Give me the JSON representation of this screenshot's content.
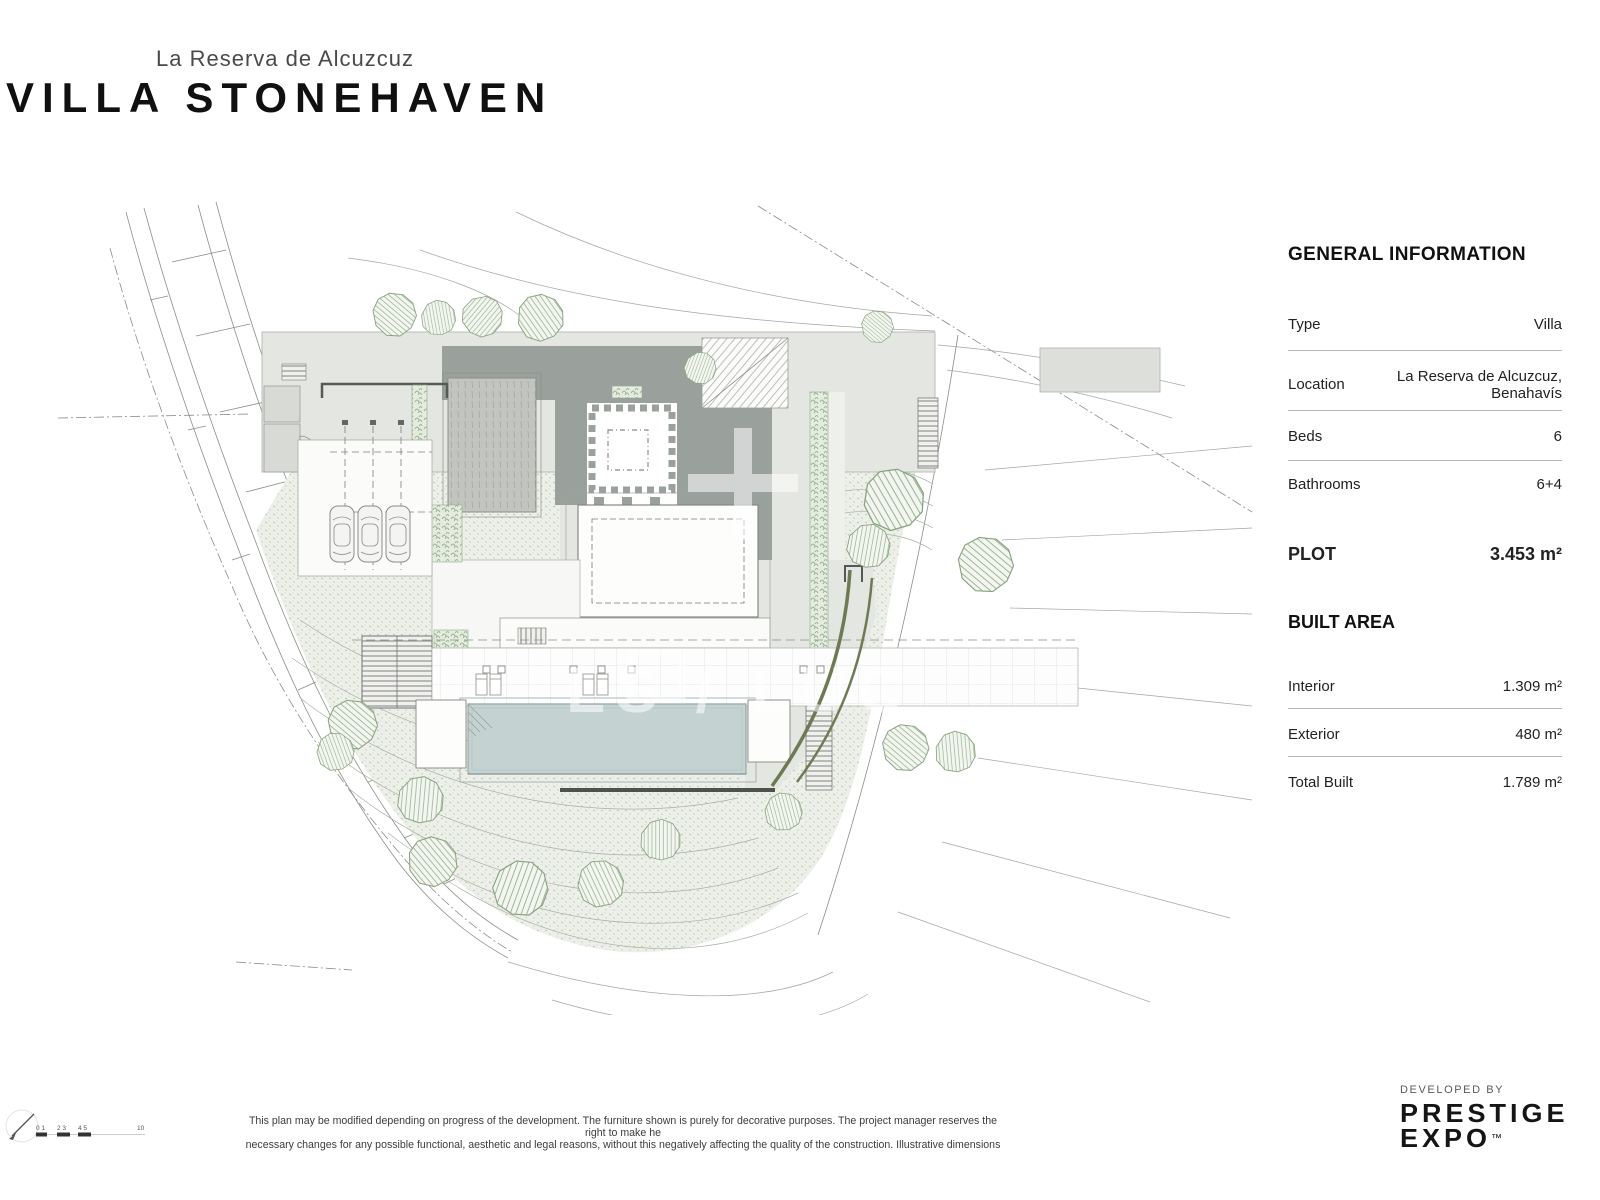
{
  "header": {
    "subtitle": "La Reserva de Alcuzcuz",
    "title": "VILLA STONEHAVEN"
  },
  "info_panel": {
    "general_title": "GENERAL INFORMATION",
    "rows": [
      {
        "label": "Type",
        "value": "Villa"
      },
      {
        "label": "Location",
        "value_line1": "La Reserva de Alcuzcuz,",
        "value_line2": "Benahavís"
      },
      {
        "label": "Beds",
        "value": "6"
      },
      {
        "label": "Bathrooms",
        "value": "6+4"
      }
    ],
    "plot": {
      "label": "PLOT",
      "value": "3.453 m²"
    },
    "built_area_title": "BUILT AREA",
    "built_rows": [
      {
        "label": "Interior",
        "value": "1.309 m²"
      },
      {
        "label": "Exterior",
        "value": "480 m²"
      },
      {
        "label": "Total Built",
        "value": "1.789 m²"
      }
    ]
  },
  "plan": {
    "watermark": "LS / LUC",
    "scalebar": {
      "labels": [
        "0 1",
        "2 3",
        "4 5",
        "10"
      ]
    }
  },
  "footer": {
    "disclaimer_line1": "This plan may be modified depending on progress of the development. The furniture shown is purely for decorative purposes. The project manager reserves the right to make he",
    "disclaimer_line2": "necessary changes for any possible functional, aesthetic and legal reasons, without this negatively affecting the quality of the construction. Illustrative dimensions",
    "developed_by": "DEVELOPED BY",
    "brand_line1": "PRESTIGE",
    "brand_line2": "EXPO",
    "brand_tm": "™"
  },
  "colors": {
    "roof_gray": "#9aa09b",
    "terrace_light": "#e4e6e2",
    "pool_blue": "#c4d3d2",
    "tree_green": "#87a27e",
    "driveway_olive": "#6e7a54",
    "stipple_bg": "#edefe9",
    "text_dark": "#1e1e1e"
  }
}
